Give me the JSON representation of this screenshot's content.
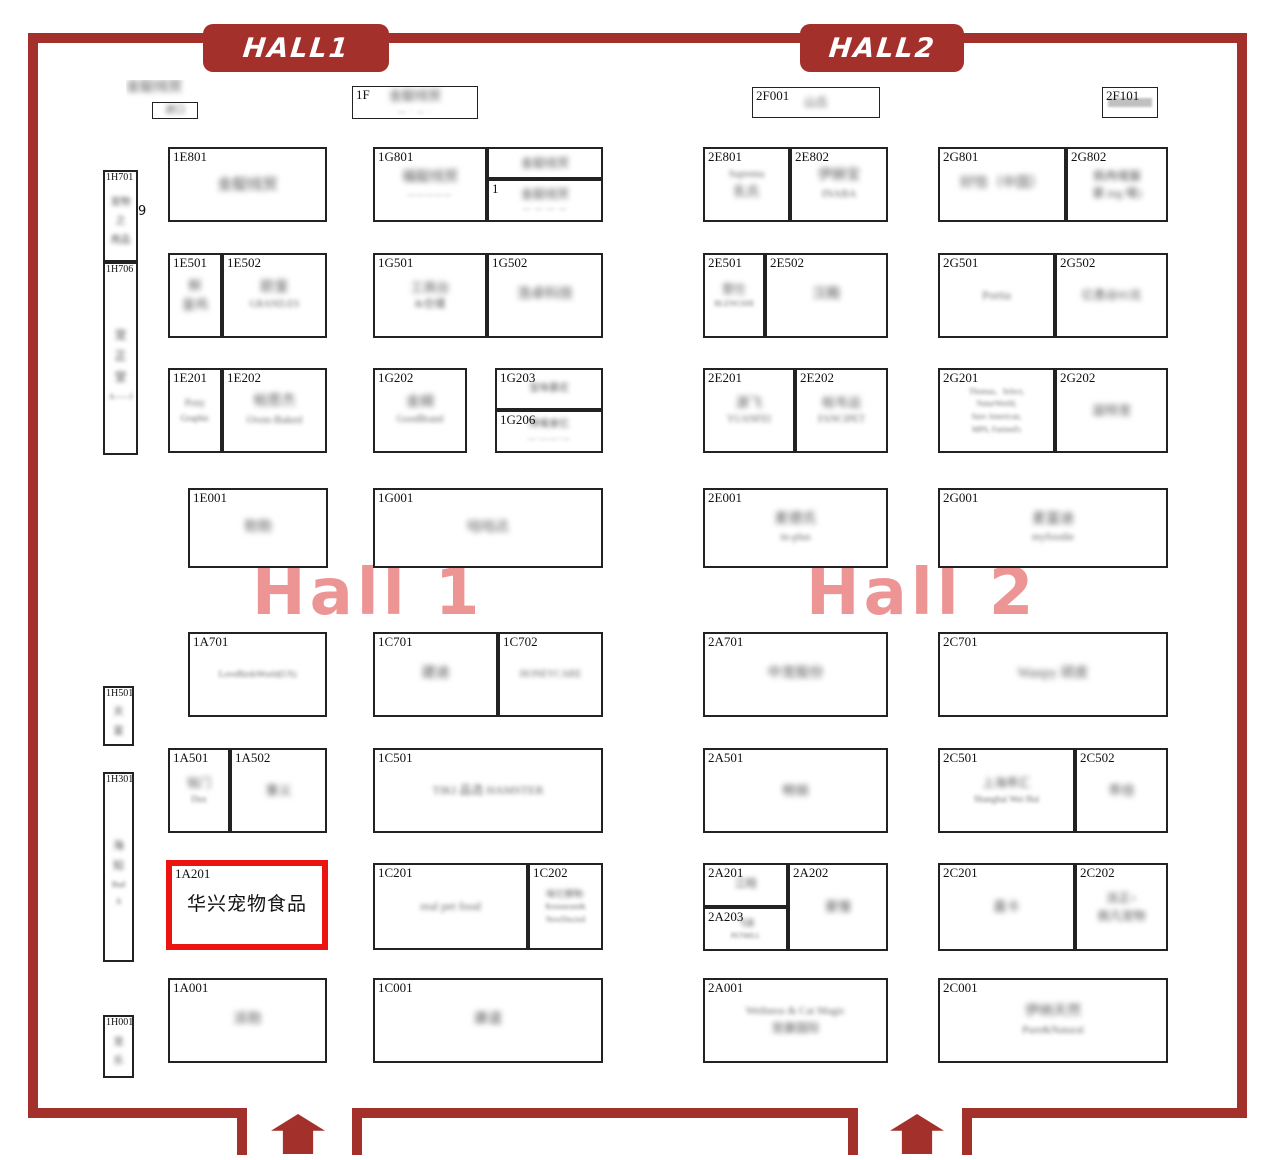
{
  "colors": {
    "border": "#a4302b",
    "highlight": "#ec1410",
    "watermark": "rgba(233,126,124,0.82)"
  },
  "banners": [
    {
      "label": "HALL1"
    },
    {
      "label": "HALL2"
    }
  ],
  "watermarks": [
    {
      "text": "Hall 1"
    },
    {
      "text": "Hall 2"
    }
  ],
  "icons": {
    "entrance_arrow": "up-arrow-entrance"
  },
  "selection": {
    "booth_id": "1A201",
    "label": "华兴宠物食品"
  },
  "booths": [
    {
      "id": "",
      "cls": "plain",
      "x": 126,
      "y": 80,
      "w": 90,
      "h": 22,
      "lines": [
        {
          "t": "金靛线贸",
          "c": "c14"
        }
      ]
    },
    {
      "id": "",
      "cls": "thin",
      "x": 152,
      "y": 102,
      "w": 46,
      "h": 17,
      "lines": [
        {
          "t": "进口",
          "c": "c10"
        }
      ]
    },
    {
      "id": "1F",
      "cls": "thin",
      "x": 352,
      "y": 86,
      "w": 126,
      "h": 33,
      "lines": [
        {
          "t": "金靛线贸",
          "c": "c13"
        },
        {
          "t": "— · — ·",
          "c": "dash"
        }
      ]
    },
    {
      "id": "2F001",
      "cls": "thin",
      "x": 752,
      "y": 87,
      "w": 128,
      "h": 31,
      "lines": [
        {
          "t": "山丘",
          "c": "c12"
        }
      ]
    },
    {
      "id": "2F101",
      "cls": "thin",
      "x": 1102,
      "y": 87,
      "w": 56,
      "h": 31,
      "lines": [
        {
          "t": "",
          "c": "gbar"
        }
      ]
    },
    {
      "id": "1H701",
      "cls": "vert",
      "x": 103,
      "y": 170,
      "w": 35,
      "h": 92,
      "lines": [
        {
          "t": "宠物",
          "c": "v10"
        },
        {
          "t": "之",
          "c": "v10"
        },
        {
          "t": "用品",
          "c": "v10"
        }
      ]
    },
    {
      "id": "",
      "cls": "plain",
      "x": 138,
      "y": 204,
      "w": 16,
      "h": 18,
      "lines": [
        {
          "t": "9",
          "c": "clear13"
        }
      ]
    },
    {
      "id": "1H706",
      "cls": "vert",
      "x": 103,
      "y": 262,
      "w": 35,
      "h": 193,
      "lines": [
        {
          "t": "宠",
          "c": "v12"
        },
        {
          "t": "正",
          "c": "v12"
        },
        {
          "t": "堂",
          "c": "v12"
        },
        {
          "t": "A——l",
          "c": "v8"
        }
      ]
    },
    {
      "id": "1H501",
      "cls": "vert",
      "x": 103,
      "y": 686,
      "w": 31,
      "h": 60,
      "lines": [
        {
          "t": "天",
          "c": "v10"
        },
        {
          "t": "富",
          "c": "v10"
        }
      ]
    },
    {
      "id": "1H301",
      "cls": "vert",
      "x": 103,
      "y": 772,
      "w": 31,
      "h": 190,
      "lines": [
        {
          "t": "海",
          "c": "v11"
        },
        {
          "t": "知",
          "c": "v11"
        },
        {
          "t": "Bud",
          "c": "v8"
        },
        {
          "t": "Ji",
          "c": "v8"
        }
      ]
    },
    {
      "id": "1H001",
      "cls": "vert",
      "x": 103,
      "y": 1015,
      "w": 31,
      "h": 63,
      "lines": [
        {
          "t": "宠",
          "c": "v10"
        },
        {
          "t": "乐",
          "c": "v10"
        }
      ]
    },
    {
      "id": "1E801",
      "x": 168,
      "y": 147,
      "w": 159,
      "h": 75,
      "lines": [
        {
          "t": "金靛线贸",
          "c": "c15"
        }
      ]
    },
    {
      "id": "1G801",
      "x": 373,
      "y": 147,
      "w": 114,
      "h": 75,
      "lines": [
        {
          "t": "福靛线贸",
          "c": "c14"
        },
        {
          "t": "—————",
          "c": "dash"
        }
      ]
    },
    {
      "id": "",
      "x": 487,
      "y": 147,
      "w": 116,
      "h": 32,
      "lines": [
        {
          "t": "金靛线贸",
          "c": "c12"
        }
      ]
    },
    {
      "id": "1",
      "x": 487,
      "y": 179,
      "w": 116,
      "h": 43,
      "lines": [
        {
          "t": "金靛线贸",
          "c": "c12"
        },
        {
          "t": "— — — —",
          "c": "dash"
        }
      ]
    },
    {
      "id": "2E801",
      "x": 703,
      "y": 147,
      "w": 87,
      "h": 75,
      "lines": [
        {
          "t": "Suprema",
          "c": "e10"
        },
        {
          "t": "乳氏",
          "c": "c13"
        }
      ]
    },
    {
      "id": "2E802",
      "x": 790,
      "y": 147,
      "w": 98,
      "h": 75,
      "lines": [
        {
          "t": "伊赫宝",
          "c": "c14"
        },
        {
          "t": "INABA",
          "c": "e11"
        }
      ]
    },
    {
      "id": "2G801",
      "x": 938,
      "y": 147,
      "w": 128,
      "h": 75,
      "lines": [
        {
          "t": "好恰（中国）",
          "c": "c14"
        }
      ]
    },
    {
      "id": "2G802",
      "x": 1066,
      "y": 147,
      "w": 102,
      "h": 75,
      "lines": [
        {
          "t": "佩冉唛脲",
          "c": "c12"
        },
        {
          "t": "豪.ing 唛)",
          "c": "c12"
        }
      ]
    },
    {
      "id": "1E501",
      "x": 168,
      "y": 253,
      "w": 54,
      "h": 85,
      "lines": [
        {
          "t": "鲜",
          "c": "c13"
        },
        {
          "t": "皇鸡",
          "c": "c13"
        }
      ]
    },
    {
      "id": "1E502",
      "x": 222,
      "y": 253,
      "w": 105,
      "h": 85,
      "lines": [
        {
          "t": "欧皇",
          "c": "c14"
        },
        {
          "t": "GRAND.ES",
          "c": "e10"
        }
      ]
    },
    {
      "id": "1G501",
      "x": 373,
      "y": 253,
      "w": 114,
      "h": 85,
      "lines": [
        {
          "t": "工商台",
          "c": "c13"
        },
        {
          "t": "&仓储",
          "c": "c11"
        }
      ]
    },
    {
      "id": "1G502",
      "x": 487,
      "y": 253,
      "w": 116,
      "h": 85,
      "lines": [
        {
          "t": "浩卓科技",
          "c": "c14"
        }
      ]
    },
    {
      "id": "2E501",
      "x": 703,
      "y": 253,
      "w": 62,
      "h": 85,
      "lines": [
        {
          "t": "登仕",
          "c": "c12"
        },
        {
          "t": "BLENGSHI",
          "c": "e8"
        }
      ]
    },
    {
      "id": "2E502",
      "x": 765,
      "y": 253,
      "w": 123,
      "h": 85,
      "lines": [
        {
          "t": "汉殿",
          "c": "c14"
        }
      ]
    },
    {
      "id": "2G501",
      "x": 938,
      "y": 253,
      "w": 117,
      "h": 85,
      "lines": [
        {
          "t": "Portia",
          "c": "e12"
        }
      ]
    },
    {
      "id": "2G502",
      "x": 1055,
      "y": 253,
      "w": 113,
      "h": 85,
      "lines": [
        {
          "t": "亿恿谷95兑",
          "c": "c12"
        }
      ]
    },
    {
      "id": "1E201",
      "x": 168,
      "y": 368,
      "w": 54,
      "h": 85,
      "lines": [
        {
          "t": "Pony",
          "c": "e10"
        },
        {
          "t": "Graphic",
          "c": "e9"
        }
      ]
    },
    {
      "id": "1E202",
      "x": 222,
      "y": 368,
      "w": 105,
      "h": 85,
      "lines": [
        {
          "t": "帕思杰",
          "c": "c14"
        },
        {
          "t": "Oven-Baked",
          "c": "e11"
        }
      ]
    },
    {
      "id": "1G202",
      "x": 373,
      "y": 368,
      "w": 94,
      "h": 85,
      "lines": [
        {
          "t": "金姆",
          "c": "c14"
        },
        {
          "t": "GoodBrand",
          "c": "e10"
        }
      ]
    },
    {
      "id": "1G203",
      "x": 495,
      "y": 368,
      "w": 108,
      "h": 42,
      "lines": [
        {
          "t": "宝味慕尼",
          "c": "c10"
        }
      ]
    },
    {
      "id": "1G206",
      "x": 495,
      "y": 410,
      "w": 108,
      "h": 43,
      "lines": [
        {
          "t": "馋嘴食忆",
          "c": "c10"
        },
        {
          "t": "—·——·—",
          "c": "dash"
        }
      ]
    },
    {
      "id": "2E201",
      "x": 703,
      "y": 368,
      "w": 92,
      "h": 85,
      "lines": [
        {
          "t": "源飞",
          "c": "c13"
        },
        {
          "t": "YUANFEI",
          "c": "e10"
        }
      ]
    },
    {
      "id": "2E202",
      "x": 795,
      "y": 368,
      "w": 93,
      "h": 85,
      "lines": [
        {
          "t": "帕韦运",
          "c": "c13"
        },
        {
          "t": "FANCIPET",
          "c": "e10"
        }
      ]
    },
    {
      "id": "2G201",
      "x": 938,
      "y": 368,
      "w": 117,
      "h": 85,
      "lines": [
        {
          "t": "Thomas、Select,",
          "c": "e8"
        },
        {
          "t": "NaturWorld,",
          "c": "e8"
        },
        {
          "t": "Sure American,",
          "c": "e8"
        },
        {
          "t": "MPS, Farmed's",
          "c": "e8"
        }
      ]
    },
    {
      "id": "2G202",
      "x": 1055,
      "y": 368,
      "w": 113,
      "h": 85,
      "lines": [
        {
          "t": "滋特宠",
          "c": "c13"
        }
      ]
    },
    {
      "id": "1E001",
      "x": 188,
      "y": 488,
      "w": 140,
      "h": 80,
      "lines": [
        {
          "t": "勃勃",
          "c": "c14"
        }
      ]
    },
    {
      "id": "1G001",
      "x": 373,
      "y": 488,
      "w": 230,
      "h": 80,
      "lines": [
        {
          "t": "咕咕达",
          "c": "c14"
        }
      ]
    },
    {
      "id": "2E001",
      "x": 703,
      "y": 488,
      "w": 185,
      "h": 80,
      "lines": [
        {
          "t": "麦德氏",
          "c": "c14"
        },
        {
          "t": "in-plus",
          "c": "e11"
        }
      ]
    },
    {
      "id": "2G001",
      "x": 938,
      "y": 488,
      "w": 230,
      "h": 80,
      "lines": [
        {
          "t": "麦富迪",
          "c": "c14"
        },
        {
          "t": "myfoodie",
          "c": "e11"
        }
      ]
    },
    {
      "id": "1A701",
      "x": 188,
      "y": 632,
      "w": 139,
      "h": 85,
      "lines": [
        {
          "t": "LoveBirdsWorld(US)",
          "c": "e9"
        }
      ]
    },
    {
      "id": "1C701",
      "x": 373,
      "y": 632,
      "w": 125,
      "h": 85,
      "lines": [
        {
          "t": "建迪",
          "c": "c14"
        }
      ]
    },
    {
      "id": "1C702",
      "x": 498,
      "y": 632,
      "w": 105,
      "h": 85,
      "lines": [
        {
          "t": "HONEYCARE",
          "c": "e10"
        }
      ]
    },
    {
      "id": "2A701",
      "x": 703,
      "y": 632,
      "w": 185,
      "h": 85,
      "lines": [
        {
          "t": "中宠股份",
          "c": "c14"
        }
      ]
    },
    {
      "id": "2C701",
      "x": 938,
      "y": 632,
      "w": 230,
      "h": 85,
      "lines": [
        {
          "t": "Wanpy 顽皮",
          "c": "c14"
        }
      ]
    },
    {
      "id": "1A501",
      "x": 168,
      "y": 748,
      "w": 62,
      "h": 85,
      "lines": [
        {
          "t": "铭门",
          "c": "c12"
        },
        {
          "t": "Dux",
          "c": "e9"
        }
      ]
    },
    {
      "id": "1A502",
      "x": 230,
      "y": 748,
      "w": 97,
      "h": 85,
      "lines": [
        {
          "t": "事义",
          "c": "c13"
        }
      ]
    },
    {
      "id": "1C501",
      "x": 373,
      "y": 748,
      "w": 230,
      "h": 85,
      "lines": [
        {
          "t": "TIKI 品选 HAMSTER",
          "c": "e12"
        }
      ]
    },
    {
      "id": "2A501",
      "x": 703,
      "y": 748,
      "w": 185,
      "h": 85,
      "lines": [
        {
          "t": "畅销",
          "c": "c13"
        }
      ]
    },
    {
      "id": "2C501",
      "x": 938,
      "y": 748,
      "w": 137,
      "h": 85,
      "lines": [
        {
          "t": "上海乖汇",
          "c": "c12"
        },
        {
          "t": "Shanghai Wei Hui",
          "c": "e9"
        }
      ]
    },
    {
      "id": "2C502",
      "x": 1075,
      "y": 748,
      "w": 93,
      "h": 85,
      "lines": [
        {
          "t": "乖倍",
          "c": "c13"
        }
      ]
    },
    {
      "id": "1A201",
      "cls": "hl",
      "x": 166,
      "y": 860,
      "w": 162,
      "h": 90,
      "lines": [
        {
          "t": "华兴宠物食品",
          "c": "clear19"
        }
      ]
    },
    {
      "id": "1C201",
      "x": 373,
      "y": 863,
      "w": 155,
      "h": 87,
      "lines": [
        {
          "t": "real pet food",
          "c": "e12"
        }
      ]
    },
    {
      "id": "1C202",
      "x": 528,
      "y": 863,
      "w": 75,
      "h": 87,
      "lines": [
        {
          "t": "味它撑物:",
          "c": "c9"
        },
        {
          "t": "Restaurant&",
          "c": "e8"
        },
        {
          "t": "NewDiscied",
          "c": "e8"
        }
      ]
    },
    {
      "id": "2A201",
      "x": 703,
      "y": 863,
      "w": 85,
      "h": 44,
      "lines": [
        {
          "t": "江翔",
          "c": "c11"
        }
      ]
    },
    {
      "id": "2A203",
      "x": 703,
      "y": 907,
      "w": 85,
      "h": 44,
      "lines": [
        {
          "t": "飞迷",
          "c": "c9"
        },
        {
          "t": "PETMILL",
          "c": "e7"
        }
      ]
    },
    {
      "id": "2A202",
      "x": 788,
      "y": 863,
      "w": 100,
      "h": 88,
      "lines": [
        {
          "t": "豪憧",
          "c": "c13"
        }
      ]
    },
    {
      "id": "2C201",
      "x": 938,
      "y": 863,
      "w": 137,
      "h": 88,
      "lines": [
        {
          "t": "嘉卡",
          "c": "c13"
        }
      ]
    },
    {
      "id": "2C202",
      "x": 1075,
      "y": 863,
      "w": 93,
      "h": 88,
      "lines": [
        {
          "t": "派正+",
          "c": "c12"
        },
        {
          "t": "佩凡宠物",
          "c": "c12"
        }
      ]
    },
    {
      "id": "1A001",
      "x": 168,
      "y": 978,
      "w": 159,
      "h": 85,
      "lines": [
        {
          "t": "派勃",
          "c": "c14"
        }
      ]
    },
    {
      "id": "1C001",
      "x": 373,
      "y": 978,
      "w": 230,
      "h": 85,
      "lines": [
        {
          "t": "康道",
          "c": "c14"
        }
      ]
    },
    {
      "id": "2A001",
      "x": 703,
      "y": 978,
      "w": 185,
      "h": 85,
      "lines": [
        {
          "t": "Wellness & Cat Magic",
          "c": "e11"
        },
        {
          "t": "宠康国际",
          "c": "c12"
        }
      ]
    },
    {
      "id": "2C001",
      "x": 938,
      "y": 978,
      "w": 230,
      "h": 85,
      "lines": [
        {
          "t": "伊纳天然",
          "c": "c14"
        },
        {
          "t": "Pure&Natural",
          "c": "e11"
        }
      ]
    }
  ]
}
